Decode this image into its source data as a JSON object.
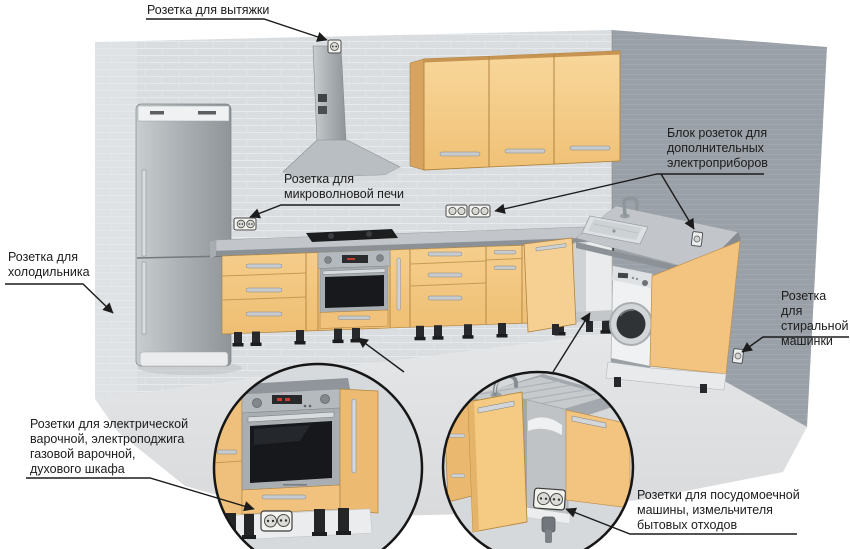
{
  "scene": {
    "type": "kitchen-outlet-placement-diagram",
    "background": "#ffffff"
  },
  "labels": {
    "hood": "Розетка для вытяжки",
    "fridge": "Розетка для\nхолодильника",
    "microwave": "Розетка для\nмикроволновой печи",
    "appliance_block": "Блок розеток для\nдополнительных\nэлектроприборов",
    "washing_machine": "Розетка для\nстиральной\nмашинки",
    "cooktop_oven": "Розетки для электрической\nварочной, электроподжига\nгазовой варочной,\nдухового шкафа",
    "dishwasher": "Розетки для посудомоечной\nмашины, измельчителя\nбытовых отходов"
  },
  "colors": {
    "cabinet_front": "#f2c581",
    "cabinet_side": "#d8a35e",
    "wall_back": "#d9dde0",
    "wall_right": "#9aa0a7",
    "floor": "#dfe1e3",
    "countertop": "#c2c6ca",
    "stainless": "#aeb4b8",
    "oven_glass": "#17191c",
    "label_text": "#1c1c1c",
    "leader_line": "#1c1c1c"
  }
}
